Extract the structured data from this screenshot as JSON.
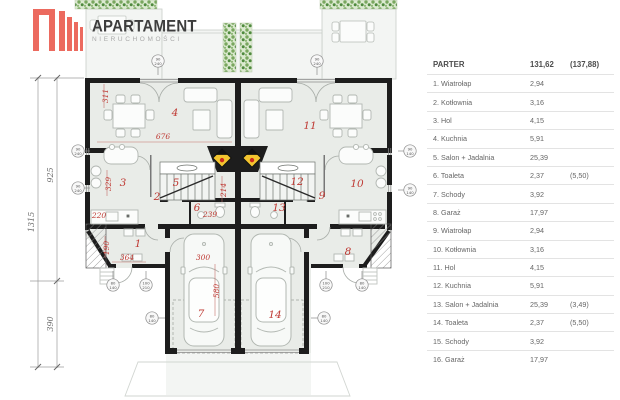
{
  "logo": {
    "title": "APARTAMENT",
    "subtitle": "NIERUCHOMOŚCI"
  },
  "legend": {
    "header": {
      "name": "PARTER",
      "area": "131,62",
      "area_alt": "(137,88)"
    },
    "rows": [
      {
        "name": "1. Wiatrołap",
        "area": "2,94",
        "area_alt": ""
      },
      {
        "name": "2. Kotłownia",
        "area": "3,16",
        "area_alt": ""
      },
      {
        "name": "3. Hol",
        "area": "4,15",
        "area_alt": ""
      },
      {
        "name": "4. Kuchnia",
        "area": "5,91",
        "area_alt": ""
      },
      {
        "name": "5. Salon + Jadalnia",
        "area": "25,39",
        "area_alt": ""
      },
      {
        "name": "6. Toaleta",
        "area": "2,37",
        "area_alt": "(5,50)"
      },
      {
        "name": "7. Schody",
        "area": "3,92",
        "area_alt": ""
      },
      {
        "name": "8. Garaż",
        "area": "17,97",
        "area_alt": ""
      },
      {
        "name": "9. Wiatrołap",
        "area": "2,94",
        "area_alt": ""
      },
      {
        "name": "10. Kotłownia",
        "area": "3,16",
        "area_alt": ""
      },
      {
        "name": "11. Hol",
        "area": "4,15",
        "area_alt": ""
      },
      {
        "name": "12. Kuchnia",
        "area": "5,91",
        "area_alt": ""
      },
      {
        "name": "13. Salon + Jadalnia",
        "area": "25,39",
        "area_alt": "(3,49)"
      },
      {
        "name": "14. Toaleta",
        "area": "2,37",
        "area_alt": "(5,50)"
      },
      {
        "name": "15. Schody",
        "area": "3,92",
        "area_alt": ""
      },
      {
        "name": "16. Garaż",
        "area": "17,97",
        "area_alt": ""
      }
    ]
  },
  "plan": {
    "room_labels": {
      "r1": "1",
      "r2": "2",
      "r3": "3",
      "r4": "4",
      "r5": "5",
      "r6": "6",
      "r7": "7",
      "r8": "8",
      "r9": "9",
      "r10": "10",
      "r11": "11",
      "r12": "12",
      "r13": "13",
      "r14": "14"
    },
    "dimensions": {
      "d311": "311",
      "d676": "676",
      "d329": "329",
      "d214": "214",
      "d220": "220",
      "d239": "239",
      "d190": "190",
      "d364": "364",
      "d300": "300",
      "d580": "580",
      "d925": "925",
      "d1315": "1315",
      "d390": "390"
    },
    "markers": {
      "win240": {
        "top": "90",
        "bot": "240"
      },
      "win140": {
        "top": "90",
        "bot": "140"
      },
      "door80": {
        "top": "80",
        "bot": "140"
      },
      "door100": {
        "top": "100",
        "bot": "210"
      }
    },
    "colors": {
      "accent_red": "#bf3a34",
      "wall": "#1d1d1d",
      "fireplace_yellow": "#f3c52f",
      "hedge_green": "#6fa258",
      "logo_red": "#ec6a5f"
    }
  }
}
